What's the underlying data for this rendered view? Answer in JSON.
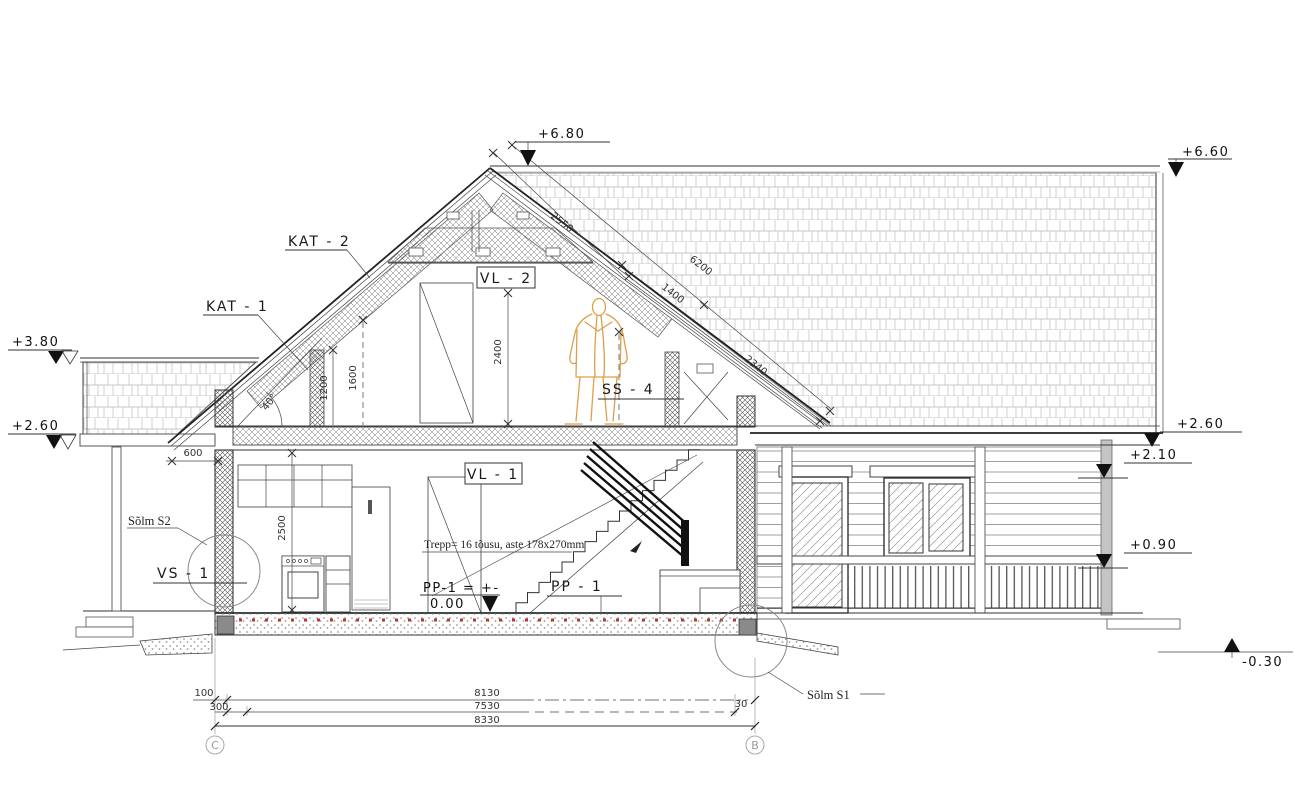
{
  "labels": {
    "kat2": "KAT - 2",
    "kat1": "KAT - 1",
    "vl2": "VL - 2",
    "vl1": "VL - 1",
    "ss4": "SS - 4",
    "pp1": "PP - 1",
    "vs1": "VS - 1",
    "solm_s2": "Sõlm S2",
    "solm_s1": "Sõlm S1"
  },
  "levels": {
    "ridge_gable": "+6.80",
    "ridge_right": "+6.60",
    "parapet_top": "+3.80",
    "canopy_left": "+2.60",
    "eave_right": "+2.60",
    "soffit_right": "+2.10",
    "railing_right": "+0.90",
    "ground_right": "-0.30",
    "floor_text_1": "PP-1 = +-",
    "floor_text_2": "0.00"
  },
  "dimensions": {
    "slope_upper": "2550",
    "slope_total": "6200",
    "slope_mid": "1400",
    "slope_lower": "2340",
    "attic_height": "2400",
    "knee_1200": "1200",
    "knee_1600": "1600",
    "floor_height": "2500",
    "eave_overhang": "600",
    "roof_angle": "40°",
    "b100": "100",
    "b300": "300",
    "b8130": "8130",
    "b7530": "7530",
    "b8330": "8330",
    "b30": "30"
  },
  "notes": {
    "stair": "Trepp= 16 tõusu, aste 178x270mm"
  },
  "grid": {
    "left": "C",
    "right": "B"
  }
}
